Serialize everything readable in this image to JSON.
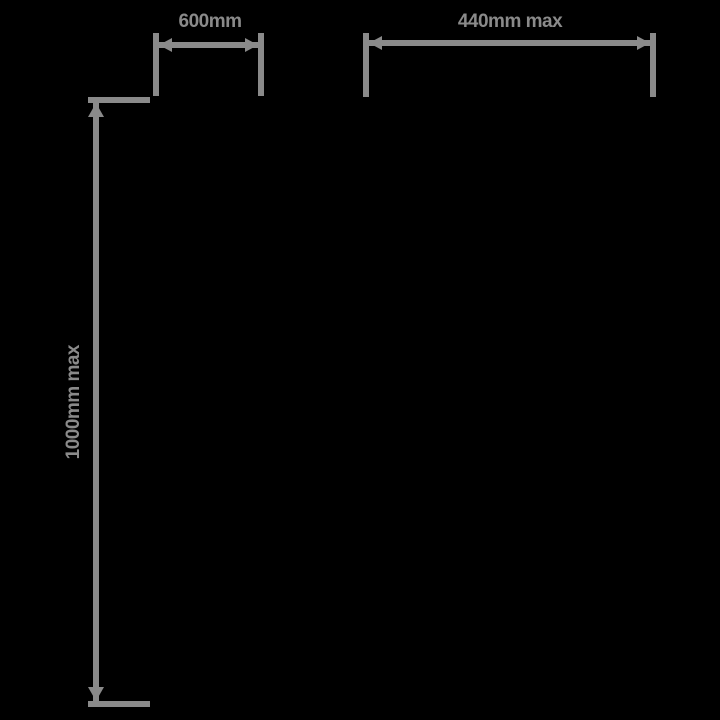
{
  "colors": {
    "background": "#000000",
    "line": "#8A8A8A",
    "text": "#8A8A8A"
  },
  "dimensions": {
    "top_left_width": {
      "label": "600mm"
    },
    "top_right_width": {
      "label": "440mm max"
    },
    "left_height": {
      "label": "1000mm max"
    }
  }
}
